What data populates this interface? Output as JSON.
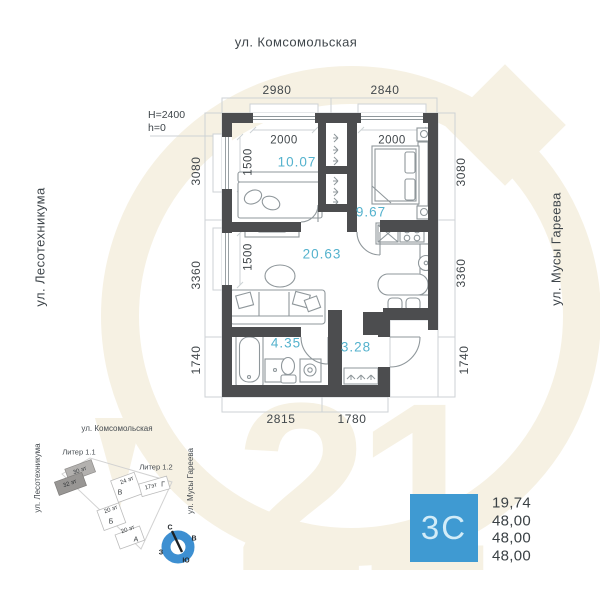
{
  "labels": {
    "street_top": "ул. Комсомольская",
    "street_left": "ул. Лесотехникума",
    "street_right": "ул. Мусы Гареева",
    "h1": "H=2400",
    "h2": "h=0"
  },
  "dims": {
    "t1": "2980",
    "t2": "2840",
    "b1": "2815",
    "b2": "1780",
    "l1": "3080",
    "l2": "3360",
    "l3": "1740",
    "r1": "3080",
    "r2": "3360",
    "r3": "1740",
    "w1": "2000",
    "w2": "2000",
    "win1": "1500",
    "win2": "1500"
  },
  "areas": {
    "room1": "10.07",
    "bedroom": "9.67",
    "living": "20.63",
    "bath": "4.35",
    "hall": "3.28"
  },
  "site": {
    "street_top": "ул. Комсомольская",
    "street_left": "ул. Лесотехникума",
    "street_right": "ул. Мусы Гареева",
    "liter1": "Литер 1.1",
    "liter2": "Литер 1.2",
    "b30": "30 эт",
    "b32": "32 эт",
    "b24": "24 эт",
    "v": "В",
    "b17": "17эт",
    "g": "Г",
    "b20a": "20 эт",
    "bB": "Б",
    "b20b": "20 эт",
    "bA": "А",
    "n": "С",
    "e": "В",
    "w": "З",
    "s": "Ю"
  },
  "summary": {
    "badge": "3С",
    "v1": "19,74",
    "v2": "48,00",
    "v3": "48,00",
    "v4": "48,00"
  },
  "colors": {
    "wall": "#4c4d4f",
    "line": "#8f979b",
    "ext": "#cdd2d5",
    "dim": "#41474b",
    "area": "#54b2cd",
    "badge-bg": "#3f9ad2",
    "badge-text": "#d2ecf8",
    "wm": "#f6f1e3",
    "compass": "#3d8fd1",
    "num": "#3a4145",
    "street": "#3f464b"
  }
}
